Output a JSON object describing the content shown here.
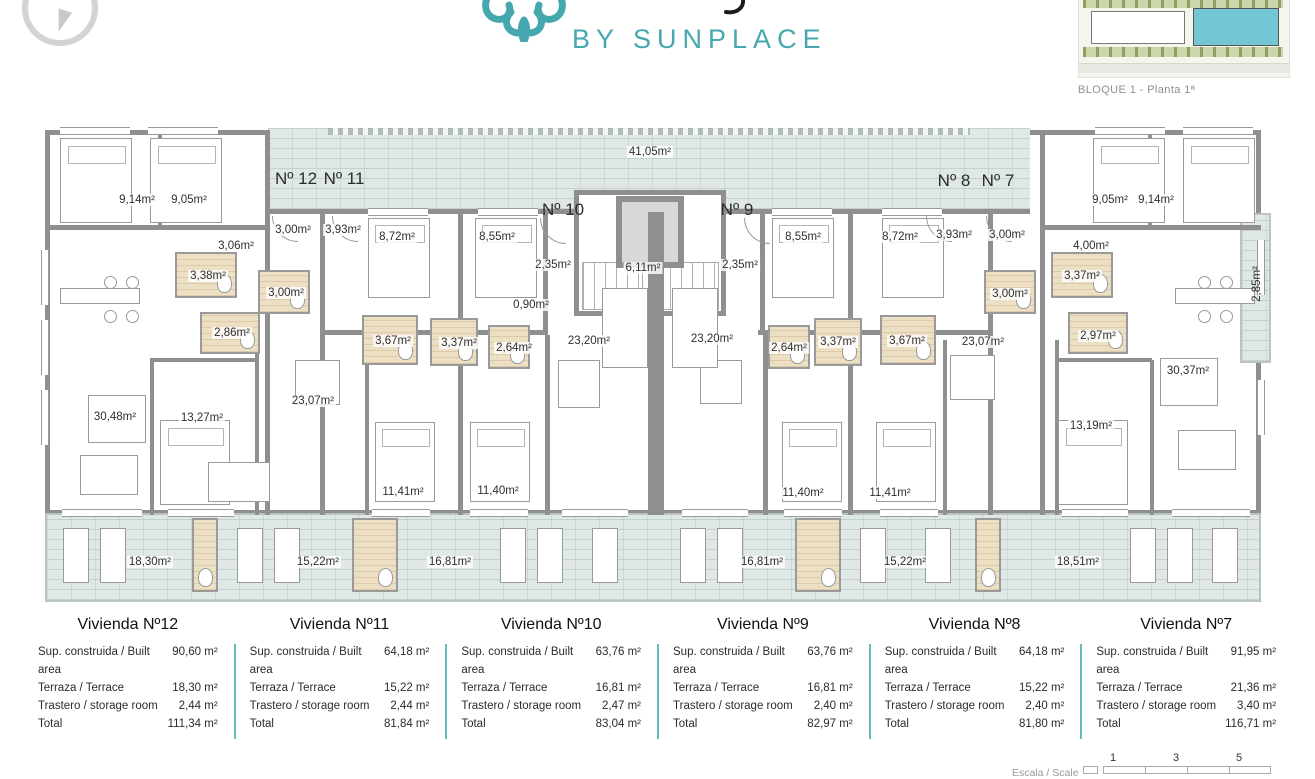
{
  "header": {
    "logo_subtitle": "BY SUNPLACE",
    "site_caption": "BLOQUE 1 - Planta 1ª"
  },
  "colors": {
    "accent_teal": "#46a8af",
    "legend_divider": "#63bcc0",
    "wall_gray": "#8f8f8f",
    "terrace_fill": "#dfe8e6",
    "bath_fill": "#ecdfc4",
    "site_building_highlight": "#74c6d4"
  },
  "floor_plan": {
    "unit_labels": [
      {
        "t": "Nº 12",
        "x": 296,
        "y": 179
      },
      {
        "t": "Nº 11",
        "x": 344,
        "y": 179
      },
      {
        "t": "Nº 10",
        "x": 563,
        "y": 210
      },
      {
        "t": "Nº 9",
        "x": 737,
        "y": 210
      },
      {
        "t": "Nº 8",
        "x": 954,
        "y": 181
      },
      {
        "t": "Nº 7",
        "x": 998,
        "y": 181
      }
    ],
    "area_labels": [
      {
        "t": "41,05m²",
        "x": 650,
        "y": 152
      },
      {
        "t": "9,14m²",
        "x": 137,
        "y": 200
      },
      {
        "t": "9,05m²",
        "x": 189,
        "y": 200
      },
      {
        "t": "3,06m²",
        "x": 236,
        "y": 246
      },
      {
        "t": "3,00m²",
        "x": 293,
        "y": 230
      },
      {
        "t": "3,93m²",
        "x": 343,
        "y": 230
      },
      {
        "t": "8,72m²",
        "x": 397,
        "y": 237
      },
      {
        "t": "8,55m²",
        "x": 497,
        "y": 237
      },
      {
        "t": "2,35m²",
        "x": 553,
        "y": 265
      },
      {
        "t": "6,11m²",
        "x": 643,
        "y": 268
      },
      {
        "t": "2,35m²",
        "x": 740,
        "y": 265
      },
      {
        "t": "8,55m²",
        "x": 803,
        "y": 237
      },
      {
        "t": "8,72m²",
        "x": 900,
        "y": 237
      },
      {
        "t": "3,93m²",
        "x": 954,
        "y": 235
      },
      {
        "t": "3,00m²",
        "x": 1007,
        "y": 235
      },
      {
        "t": "9,05m²",
        "x": 1110,
        "y": 200
      },
      {
        "t": "9,14m²",
        "x": 1156,
        "y": 200
      },
      {
        "t": "4,00m²",
        "x": 1091,
        "y": 246
      },
      {
        "t": "3,38m²",
        "x": 208,
        "y": 276
      },
      {
        "t": "3,00m²",
        "x": 286,
        "y": 293
      },
      {
        "t": "2,86m²",
        "x": 232,
        "y": 333
      },
      {
        "t": "0,90m²",
        "x": 531,
        "y": 305
      },
      {
        "t": "3,67m²",
        "x": 393,
        "y": 341
      },
      {
        "t": "3,37m²",
        "x": 459,
        "y": 343
      },
      {
        "t": "2,64m²",
        "x": 514,
        "y": 348
      },
      {
        "t": "23,20m²",
        "x": 589,
        "y": 341
      },
      {
        "t": "23,20m²",
        "x": 712,
        "y": 339
      },
      {
        "t": "2,64m²",
        "x": 789,
        "y": 348
      },
      {
        "t": "3,37m²",
        "x": 838,
        "y": 342
      },
      {
        "t": "3,67m²",
        "x": 907,
        "y": 341
      },
      {
        "t": "3,00m²",
        "x": 1010,
        "y": 294
      },
      {
        "t": "3,37m²",
        "x": 1082,
        "y": 276
      },
      {
        "t": "2,97m²",
        "x": 1098,
        "y": 336
      },
      {
        "t": "30,48m²",
        "x": 115,
        "y": 417
      },
      {
        "t": "13,27m²",
        "x": 202,
        "y": 418
      },
      {
        "t": "23,07m²",
        "x": 313,
        "y": 401
      },
      {
        "t": "23,07m²",
        "x": 983,
        "y": 342
      },
      {
        "t": "13,19m²",
        "x": 1091,
        "y": 426
      },
      {
        "t": "30,37m²",
        "x": 1188,
        "y": 371
      },
      {
        "t": "11,41m²",
        "x": 403,
        "y": 492
      },
      {
        "t": "11,40m²",
        "x": 498,
        "y": 491
      },
      {
        "t": "11,40m²",
        "x": 803,
        "y": 493
      },
      {
        "t": "11,41m²",
        "x": 890,
        "y": 493
      },
      {
        "t": "18,30m²",
        "x": 150,
        "y": 562
      },
      {
        "t": "15,22m²",
        "x": 318,
        "y": 562
      },
      {
        "t": "16,81m²",
        "x": 450,
        "y": 562
      },
      {
        "t": "16,81m²",
        "x": 762,
        "y": 562
      },
      {
        "t": "15,22m²",
        "x": 905,
        "y": 562
      },
      {
        "t": "18,51m²",
        "x": 1078,
        "y": 562
      }
    ],
    "vertical_labels": [
      {
        "t": "2,85m²",
        "x": 1257,
        "y": 284
      }
    ]
  },
  "legend": {
    "row_labels": [
      "Sup. construida / Built area",
      "Terraza / Terrace",
      "Trastero / storage room",
      "Total"
    ],
    "units": [
      {
        "title": "Vivienda Nº12",
        "values": [
          "90,60 m²",
          "18,30 m²",
          "2,44 m²",
          "111,34 m²"
        ]
      },
      {
        "title": "Vivienda Nº11",
        "values": [
          "64,18 m²",
          "15,22 m²",
          "2,44 m²",
          "81,84 m²"
        ]
      },
      {
        "title": "Vivienda Nº10",
        "values": [
          "63,76 m²",
          "16,81 m²",
          "2,47 m²",
          "83,04 m²"
        ]
      },
      {
        "title": "Vivienda Nº9",
        "values": [
          "63,76 m²",
          "16,81 m²",
          "2,40 m²",
          "82,97 m²"
        ]
      },
      {
        "title": "Vivienda Nº8",
        "values": [
          "64,18 m²",
          "15,22 m²",
          "2,40 m²",
          "81,80 m²"
        ]
      },
      {
        "title": "Vivienda Nº7",
        "values": [
          "91,95 m²",
          "21,36 m²",
          "3,40 m²",
          "116,71 m²"
        ]
      }
    ]
  },
  "scale": {
    "label": "Escala / Scale",
    "ticks": [
      "1",
      "3",
      "5"
    ]
  }
}
